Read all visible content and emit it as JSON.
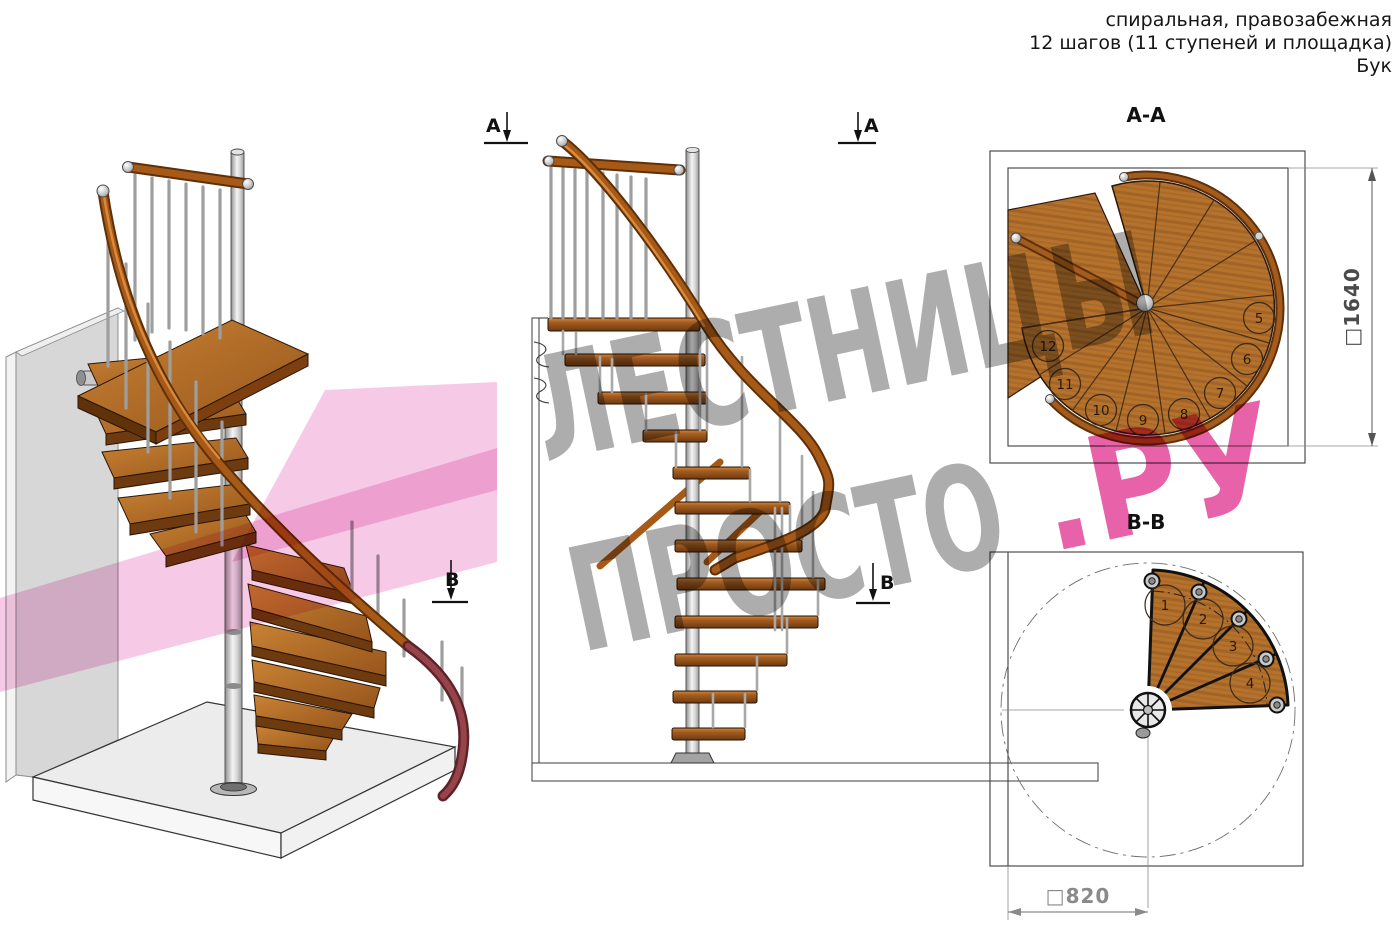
{
  "header": {
    "line1": "спиральная, правозабежная",
    "line2": "12 шагов (11 ступеней и площадка)",
    "line3": "Бук"
  },
  "watermark": {
    "word1": "ЛЕСТНИЦЫ",
    "word2": "ПРОСТО",
    "suffix": ".РУ"
  },
  "markers": {
    "a": "А",
    "b": "В"
  },
  "sections": {
    "aa": {
      "label": "А-А",
      "dimension": "□1640",
      "step_numbers": [
        "5",
        "6",
        "7",
        "8",
        "9",
        "10",
        "11",
        "12"
      ]
    },
    "bb": {
      "label": "В-В",
      "dimension": "□820",
      "step_numbers": [
        "1",
        "2",
        "3",
        "4"
      ]
    }
  },
  "colors": {
    "wood": "#b5722c",
    "wood_dark": "#7d481a",
    "rail": "#a75a17",
    "metal": "#c9c9c9",
    "watermark_grey": "#9b9b9b",
    "watermark_pink": "#e23f96",
    "plane_pink": "#ef9ed1"
  }
}
